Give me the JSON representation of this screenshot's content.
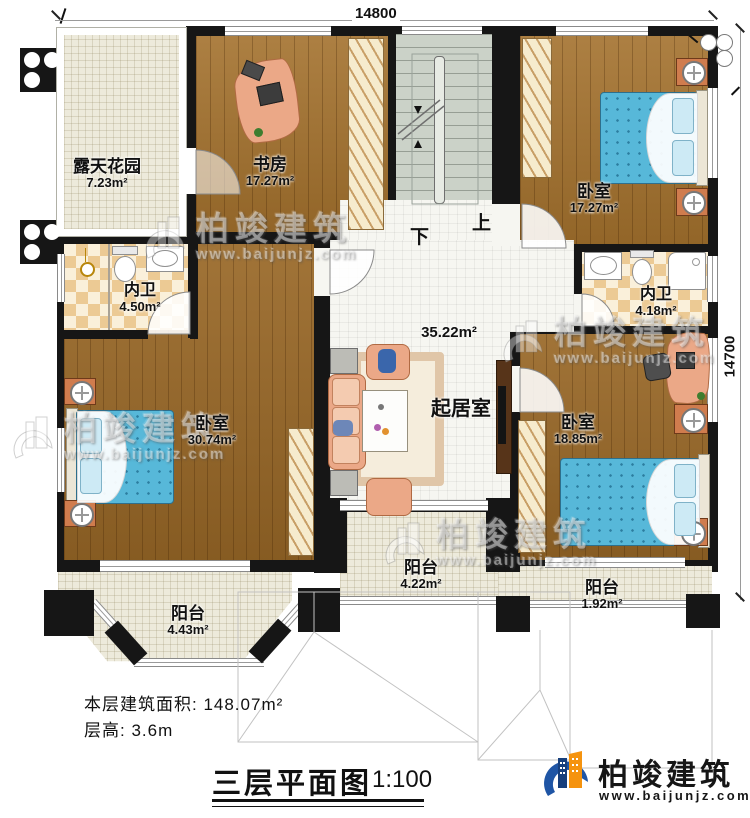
{
  "dimensions": {
    "top": "14800",
    "right": "14700"
  },
  "stairs": {
    "up": "上",
    "down": "下"
  },
  "rooms": {
    "garden": {
      "name": "露天花园",
      "area": "7.23m²"
    },
    "study": {
      "name": "书房",
      "area": "17.27m²"
    },
    "bedroom_tr": {
      "name": "卧室",
      "area": "17.27m²"
    },
    "bath_left": {
      "name": "内卫",
      "area": "4.50m²"
    },
    "bath_right": {
      "name": "内卫",
      "area": "4.18m²"
    },
    "bedroom_left": {
      "name": "卧室",
      "area": "30.74m²"
    },
    "living": {
      "name": "起居室",
      "area": "35.22m²"
    },
    "bedroom_right": {
      "name": "卧室",
      "area": "18.85m²"
    },
    "balcony_left": {
      "name": "阳台",
      "area": "4.43m²"
    },
    "balcony_center": {
      "name": "阳台",
      "area": "4.22m²"
    },
    "balcony_right": {
      "name": "阳台",
      "area": "1.92m²"
    }
  },
  "notes": {
    "floor_area": "本层建筑面积: 148.07m²",
    "floor_height": "层高: 3.6m"
  },
  "title": {
    "text": "三层平面图",
    "scale": "1:100"
  },
  "brand": {
    "name": "柏竣建筑",
    "url": "www.baijunjz.com"
  },
  "watermark": {
    "name": "柏竣建筑",
    "url": "www.baijunjz.com"
  },
  "colors": {
    "wall": "#161616",
    "wood_floor": "#a3712d",
    "mattress_blue": "#57b8d9",
    "brand_blue": "#1f55a5",
    "brand_orange": "#f5930f"
  }
}
